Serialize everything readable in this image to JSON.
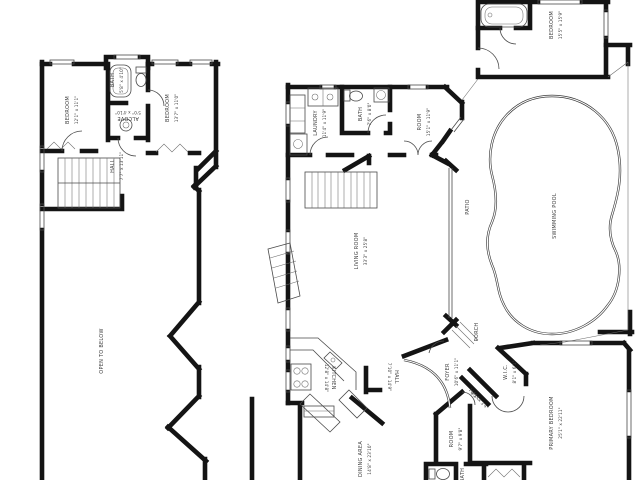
{
  "image": {
    "kind": "real-estate floor plan, two levels, labels rotated sideways",
    "colors": {
      "background": "#ffffff",
      "wall": "#141414",
      "thin_line": "#4a4a4a",
      "text": "#3d3d3d"
    }
  },
  "labels": {
    "upper_bedroom1": {
      "name": "BEDROOM",
      "dims": "12'1\" x 11'1\""
    },
    "upper_bath": {
      "name": "BATH",
      "dims": "5'8\" x 4'10\""
    },
    "upper_alcove": {
      "name": "ALCOVE",
      "dims": "5'0\" x 4'10\""
    },
    "upper_bedroom2": {
      "name": "BEDROOM",
      "dims": "13'7\" x 11'0\""
    },
    "upper_hall": {
      "name": "HALL",
      "dims": "7'7\" x 13'11\""
    },
    "open_to_below": {
      "name": "OPEN TO BELOW",
      "dims": ""
    },
    "laundry": {
      "name": "LAUNDRY",
      "dims": "11'4\" x 11'9\""
    },
    "main_bath": {
      "name": "BATH",
      "dims": "7'6\" x 8'0\""
    },
    "room_den": {
      "name": "ROOM",
      "dims": "15'1\" x 11'9\""
    },
    "patio": {
      "name": "PATIO",
      "dims": ""
    },
    "living_room": {
      "name": "LIVING ROOM",
      "dims": "33'3\" x 25'8\""
    },
    "swimming_pool": {
      "name": "SWIMMING POOL",
      "dims": ""
    },
    "kitchen": {
      "name": "KITCHEN",
      "dims": "12'8\" x 14'8\""
    },
    "kitchen_hall": {
      "name": "HALL",
      "dims": "7'10\" x 14'9\""
    },
    "dining_area": {
      "name": "DINING AREA",
      "dims": "14'8\" x 23'10\""
    },
    "foyer": {
      "name": "FOYER",
      "dims": "10'6\" x 11'1\""
    },
    "porch": {
      "name": "PORCH",
      "dims": ""
    },
    "wic": {
      "name": "W.I.C.",
      "dims": "8'1\" x 6'1\""
    },
    "diag_hall": {
      "name": "HALL",
      "dims": "8'2\" x 3'4\""
    },
    "small_room": {
      "name": "ROOM",
      "dims": "9'7\" x 9'8\""
    },
    "primary_bedroom": {
      "name": "PRIMARY BEDROOM",
      "dims": "25'1\" x 22'11\""
    },
    "suite_bedroom": {
      "name": "BEDROOM",
      "dims": "15'5\" x 15'9\""
    },
    "lower_bath": {
      "name": "BATH",
      "dims": ""
    }
  }
}
